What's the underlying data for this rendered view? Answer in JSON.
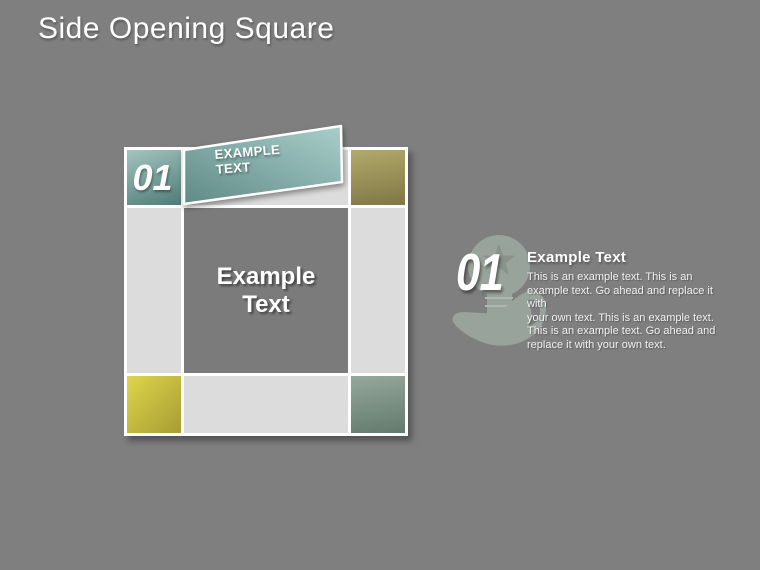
{
  "slide": {
    "title": "Side Opening Square"
  },
  "square": {
    "corner_number": "01",
    "flap_label_line1": "EXAMPLE",
    "flap_label_line2": "TEXT",
    "center_line1": "Example",
    "center_line2": "Text"
  },
  "right_item": {
    "number": "01",
    "heading": "Example Text",
    "icon": "hand-holding-lightbulb-star-icon",
    "body_lines": [
      "This is an example text. This is an",
      "example text. Go ahead and replace it with",
      "your own text. This is an example text.",
      "This is an example text. Go ahead and",
      "replace it with your own text."
    ]
  },
  "colors": {
    "page-bg": "#7f7f7f",
    "title-text": "#ffffff",
    "cell-light": "#dcdcdc",
    "cell-center": "#7b7b7b",
    "teal-light": "#a3c4c0",
    "teal-dark": "#4f7b77",
    "flap-light": "#a9ceca",
    "flap-dark": "#5f8a86",
    "olive-light": "#b2a96b",
    "olive-dark": "#7f7745",
    "yellow-light": "#ded54b",
    "yellow-dark": "#a79d33",
    "sage-light": "#95a89b",
    "sage-dark": "#637a6d",
    "icon-fill": "#9fada3",
    "icon-star": "#8a988e",
    "icon-gap": "#bcc5bd"
  }
}
